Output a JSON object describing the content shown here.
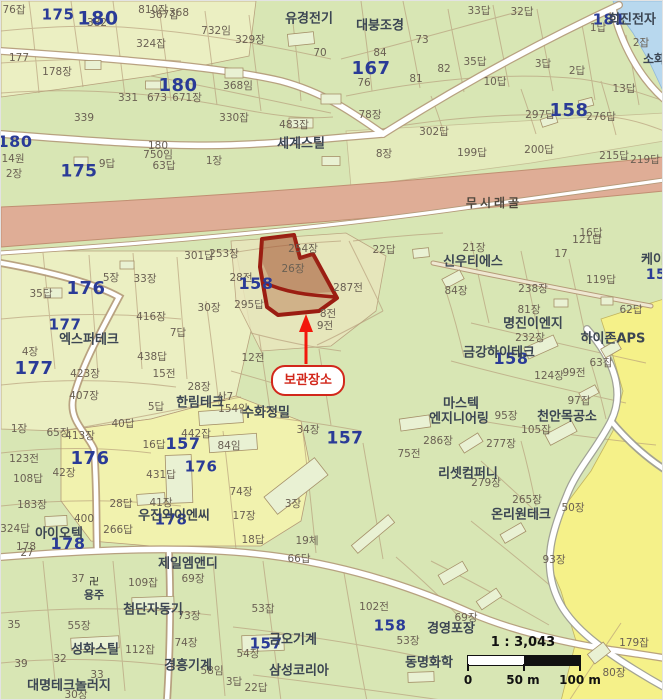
{
  "label_format": "[text, x, y, optionalFontSizePx]",
  "colors": {
    "highlight_red": "#d2271b",
    "arrow_red": "#f2170c",
    "parcel_outline_red": "#9b1d12",
    "district_blue": "#2a3b97",
    "company_navy": "#3c4653",
    "parcel_text": "#6a6053",
    "base_green": "#d8e6b4",
    "pale_parcel": "#eef0c4",
    "bright_yellow": "#f5f189",
    "water_blue": "#b8d8ee",
    "road_band_pink": "#dfad96"
  },
  "callout": {
    "text": "보관장소"
  },
  "scale_bar": {
    "ratio": "1 : 3,043",
    "ticks": [
      "0",
      "50 m",
      "100 m"
    ]
  },
  "icons": [
    {
      "name": "temple-icon",
      "glyph": "卍",
      "x": 93,
      "y": 582
    }
  ],
  "labels": {
    "road": [
      [
        "무시래골",
        493,
        202
      ]
    ],
    "district": [
      [
        "175",
        57,
        14,
        15
      ],
      [
        "180",
        97,
        18,
        19
      ],
      [
        "167",
        370,
        68,
        18
      ],
      [
        "180",
        177,
        85,
        18
      ],
      [
        "158",
        568,
        110,
        18
      ],
      [
        "180",
        14,
        141,
        16
      ],
      [
        "175",
        78,
        171,
        17
      ],
      [
        "176",
        85,
        288,
        18
      ],
      [
        "158",
        255,
        283,
        16
      ],
      [
        "177",
        64,
        324,
        15
      ],
      [
        "177",
        33,
        368,
        18
      ],
      [
        "176",
        89,
        458,
        18
      ],
      [
        "157",
        182,
        443,
        16
      ],
      [
        "157",
        344,
        438,
        17
      ],
      [
        "176",
        200,
        466,
        15
      ],
      [
        "178",
        67,
        543,
        16
      ],
      [
        "178",
        170,
        519,
        15
      ],
      [
        "158",
        510,
        358,
        16
      ],
      [
        "158",
        389,
        625,
        15
      ],
      [
        "157",
        265,
        643,
        15
      ],
      [
        "181",
        608,
        19,
        15
      ],
      [
        "15",
        655,
        274,
        14
      ]
    ],
    "company": [
      [
        "유경전기",
        308,
        18
      ],
      [
        "대붕조경",
        379,
        25
      ],
      [
        "희진전자",
        631,
        19
      ],
      [
        "세계스틸",
        300,
        143
      ],
      [
        "엑스퍼테크",
        88,
        339
      ],
      [
        "한림테크",
        199,
        402
      ],
      [
        "수화정밀",
        265,
        412
      ],
      [
        "신우티에스",
        472,
        261
      ],
      [
        "명진이엔지",
        532,
        323
      ],
      [
        "금강하이테크",
        498,
        352
      ],
      [
        "하이존APS",
        612,
        338
      ],
      [
        "케이",
        652,
        259
      ],
      [
        "마스텍",
        460,
        403
      ],
      [
        "엔지니어링",
        458,
        418
      ],
      [
        "천안목공소",
        566,
        416
      ],
      [
        "리셋컴퍼니",
        467,
        473
      ],
      [
        "온리원테크",
        520,
        514
      ],
      [
        "아이오텍",
        58,
        533
      ],
      [
        "우진와이엔씨",
        173,
        515
      ],
      [
        "제일엠앤디",
        187,
        563
      ],
      [
        "첨단자동기",
        152,
        609
      ],
      [
        "성화스틸",
        94,
        649
      ],
      [
        "경흥기계",
        187,
        665
      ],
      [
        "대명테크놀러지",
        68,
        685
      ],
      [
        "금오기계",
        292,
        639
      ],
      [
        "삼성코리아",
        298,
        670
      ],
      [
        "경영포장",
        450,
        628
      ],
      [
        "동명화학",
        428,
        662
      ],
      [
        "용주",
        93,
        594,
        11
      ],
      [
        "소화",
        653,
        58,
        12
      ]
    ],
    "parcel": [
      [
        "76잡",
        13,
        9
      ],
      [
        "382",
        96,
        22
      ],
      [
        "810장",
        152,
        9
      ],
      [
        "367잡",
        163,
        14
      ],
      [
        "368",
        178,
        12
      ],
      [
        "732임",
        215,
        30
      ],
      [
        "329장",
        249,
        39
      ],
      [
        "324잡",
        150,
        43
      ],
      [
        "70",
        319,
        52
      ],
      [
        "177",
        18,
        57
      ],
      [
        "178장",
        56,
        71
      ],
      [
        "331",
        127,
        97
      ],
      [
        "673",
        156,
        97
      ],
      [
        "671장",
        186,
        97
      ],
      [
        "368임",
        237,
        85
      ],
      [
        "339",
        83,
        117
      ],
      [
        "330잡",
        233,
        117
      ],
      [
        "483잡",
        293,
        124
      ],
      [
        "14원",
        12,
        158
      ],
      [
        "2장",
        13,
        173
      ],
      [
        "9답",
        106,
        163
      ],
      [
        "180",
        157,
        145
      ],
      [
        "750임",
        157,
        154
      ],
      [
        "63답",
        163,
        165
      ],
      [
        "1장",
        213,
        160
      ],
      [
        "33답",
        478,
        10
      ],
      [
        "32답",
        521,
        11
      ],
      [
        "73",
        421,
        39
      ],
      [
        "84",
        379,
        52
      ],
      [
        "76",
        363,
        82
      ],
      [
        "82",
        443,
        68
      ],
      [
        "81",
        415,
        78
      ],
      [
        "35답",
        474,
        61
      ],
      [
        "10답",
        494,
        81
      ],
      [
        "3답",
        542,
        63
      ],
      [
        "2답",
        576,
        70
      ],
      [
        "13답",
        623,
        88
      ],
      [
        "297답",
        539,
        114
      ],
      [
        "276답",
        600,
        116
      ],
      [
        "78장",
        369,
        114
      ],
      [
        "302답",
        433,
        131
      ],
      [
        "8장",
        383,
        153
      ],
      [
        "199답",
        471,
        152
      ],
      [
        "200답",
        538,
        149
      ],
      [
        "215답",
        613,
        155
      ],
      [
        "219답",
        644,
        159
      ],
      [
        "1답",
        597,
        27
      ],
      [
        "2잡",
        640,
        42
      ],
      [
        "301답",
        198,
        255
      ],
      [
        "253장",
        223,
        253
      ],
      [
        "254장",
        302,
        248
      ],
      [
        "26장",
        292,
        268
      ],
      [
        "22답",
        383,
        249
      ],
      [
        "287전",
        347,
        287
      ],
      [
        "295답",
        248,
        304
      ],
      [
        "28전",
        240,
        277
      ],
      [
        "8전",
        327,
        313
      ],
      [
        "9전",
        324,
        325
      ],
      [
        "12전",
        252,
        357
      ],
      [
        "5장",
        110,
        277
      ],
      [
        "33장",
        144,
        278
      ],
      [
        "35답",
        40,
        293
      ],
      [
        "416장",
        150,
        316
      ],
      [
        "30장",
        208,
        307
      ],
      [
        "4장",
        29,
        351
      ],
      [
        "423장",
        84,
        373
      ],
      [
        "407장",
        83,
        395
      ],
      [
        "438답",
        151,
        356
      ],
      [
        "7답",
        177,
        332
      ],
      [
        "15전",
        163,
        373
      ],
      [
        "28장",
        198,
        386
      ],
      [
        "5답",
        155,
        406
      ],
      [
        "산7",
        224,
        396
      ],
      [
        "154임",
        232,
        408
      ],
      [
        "442잡",
        195,
        433
      ],
      [
        "84임",
        228,
        445
      ],
      [
        "34장",
        307,
        429
      ],
      [
        "431답",
        160,
        474
      ],
      [
        "74장",
        240,
        491
      ],
      [
        "3장",
        292,
        503
      ],
      [
        "41장",
        160,
        502
      ],
      [
        "123전",
        23,
        458
      ],
      [
        "42장",
        63,
        472
      ],
      [
        "108답",
        27,
        478
      ],
      [
        "16답",
        153,
        444
      ],
      [
        "40답",
        122,
        423
      ],
      [
        "1장",
        18,
        428
      ],
      [
        "65장",
        57,
        432
      ],
      [
        "413장",
        79,
        435
      ],
      [
        "183장",
        31,
        504
      ],
      [
        "400",
        83,
        518
      ],
      [
        "324답",
        14,
        528
      ],
      [
        "28답",
        120,
        503
      ],
      [
        "266답",
        117,
        529
      ],
      [
        "17장",
        243,
        515
      ],
      [
        "18답",
        252,
        539
      ],
      [
        "19체",
        306,
        540
      ],
      [
        "66답",
        298,
        558
      ],
      [
        "3답",
        233,
        681
      ],
      [
        "22답",
        255,
        687
      ],
      [
        "54장",
        247,
        653
      ],
      [
        "53잡",
        262,
        608
      ],
      [
        "102전",
        373,
        606
      ],
      [
        "53장",
        407,
        640
      ],
      [
        "109잡",
        142,
        582
      ],
      [
        "37",
        77,
        578
      ],
      [
        "69장",
        192,
        578
      ],
      [
        "73장",
        188,
        615
      ],
      [
        "55장",
        78,
        625
      ],
      [
        "35",
        13,
        624
      ],
      [
        "74장",
        185,
        642
      ],
      [
        "112잡",
        139,
        649
      ],
      [
        "32",
        59,
        658
      ],
      [
        "39",
        20,
        663
      ],
      [
        "58임",
        211,
        670
      ],
      [
        "33",
        96,
        674
      ],
      [
        "30장",
        75,
        694
      ],
      [
        "179잡",
        633,
        642
      ],
      [
        "80장",
        613,
        672
      ],
      [
        "69장",
        465,
        617
      ],
      [
        "93장",
        553,
        559
      ],
      [
        "50장",
        572,
        507
      ],
      [
        "265장",
        526,
        499
      ],
      [
        "279장",
        485,
        482
      ],
      [
        "286장",
        437,
        440
      ],
      [
        "75전",
        408,
        453
      ],
      [
        "95장",
        505,
        415
      ],
      [
        "277장",
        500,
        443
      ],
      [
        "105잡",
        535,
        429
      ],
      [
        "97잡",
        578,
        400
      ],
      [
        "99전",
        573,
        372
      ],
      [
        "124장",
        548,
        375
      ],
      [
        "63잡",
        600,
        362
      ],
      [
        "232장",
        529,
        337
      ],
      [
        "81장",
        528,
        309
      ],
      [
        "238장",
        532,
        288
      ],
      [
        "84장",
        455,
        290
      ],
      [
        "21장",
        473,
        247
      ],
      [
        "119답",
        600,
        279
      ],
      [
        "121답",
        586,
        239
      ],
      [
        "16답",
        590,
        232
      ],
      [
        "17",
        560,
        253
      ],
      [
        "62답",
        630,
        309
      ],
      [
        "178",
        25,
        546
      ],
      [
        "27",
        26,
        552
      ]
    ]
  }
}
